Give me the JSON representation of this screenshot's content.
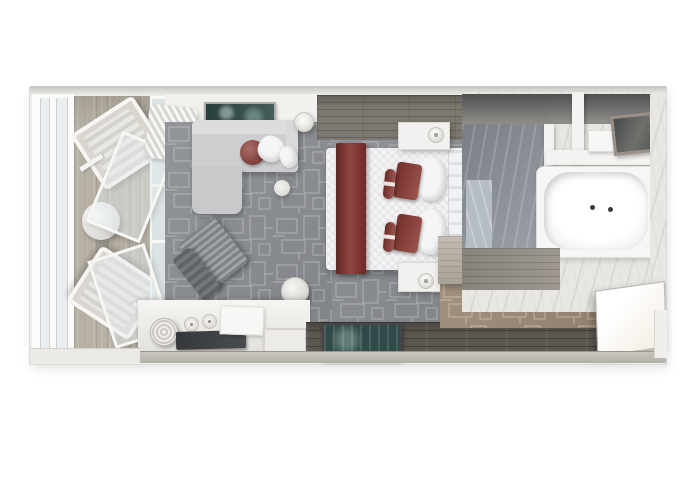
{
  "meta": {
    "title": "Cruise ship balcony suite stateroom - top-down 3D floor plan rendering",
    "render_type": "photorealistic plan view",
    "canvas": {
      "width": 680,
      "height": 486
    }
  },
  "palette": {
    "background": "#ffffff",
    "wall": "#efeeeb",
    "carpet_gray": "#8b8e93",
    "carpet_tan": "#9c8c79",
    "balcony_wood": "#b7b0a4",
    "walkway_wood": "#7d7970",
    "entry_wood": "#5d5751",
    "bathroom_wood": "#989289",
    "marble_white": "#e9e7e3",
    "marble_gray": "#949aa2",
    "bed_linen": "#f3f3f5",
    "accent_red": "#84322c",
    "pillow_red": "#8e3b35",
    "teal_art": "#35524f",
    "teal_mat": "#2f4a48",
    "sofa_gray": "#ccced0",
    "furniture_white": "#f2f1ef"
  },
  "zones": {
    "balcony": {
      "label": "private veranda",
      "objects": [
        "lounge-chair",
        "lounge-chair",
        "round-cocktail-table",
        "glass-railing",
        "sliding-glass-door"
      ]
    },
    "living_area": {
      "label": "sitting area",
      "objects": [
        "sofa-with-chaise",
        "red-round-pillow",
        "white-pillows",
        "wall-art",
        "curtain",
        "floor-lamp",
        "side-table",
        "ribbed-lounge-chair",
        "ottoman",
        "media-console",
        "tv-panel",
        "ice-bucket",
        "glasses",
        "amenity-box",
        "bar-tray"
      ]
    },
    "bedroom": {
      "label": "sleeping area",
      "objects": [
        "queen-bed",
        "red-bed-runner",
        "red-accent-pillows",
        "bolster-pillows",
        "headboard",
        "nightstand-with-lamp",
        "nightstand-with-lamp",
        "entry-mat",
        "vanity-desk"
      ]
    },
    "bathroom": {
      "label": "marble bathroom",
      "objects": [
        "walk-in-shower",
        "bathtub",
        "tub-faucet",
        "vanity-shelf",
        "mirror"
      ]
    },
    "entry": {
      "label": "entry hall / closet",
      "objects": [
        "cabin-door",
        "hardwood-floor",
        "patterned-carpet"
      ]
    }
  }
}
